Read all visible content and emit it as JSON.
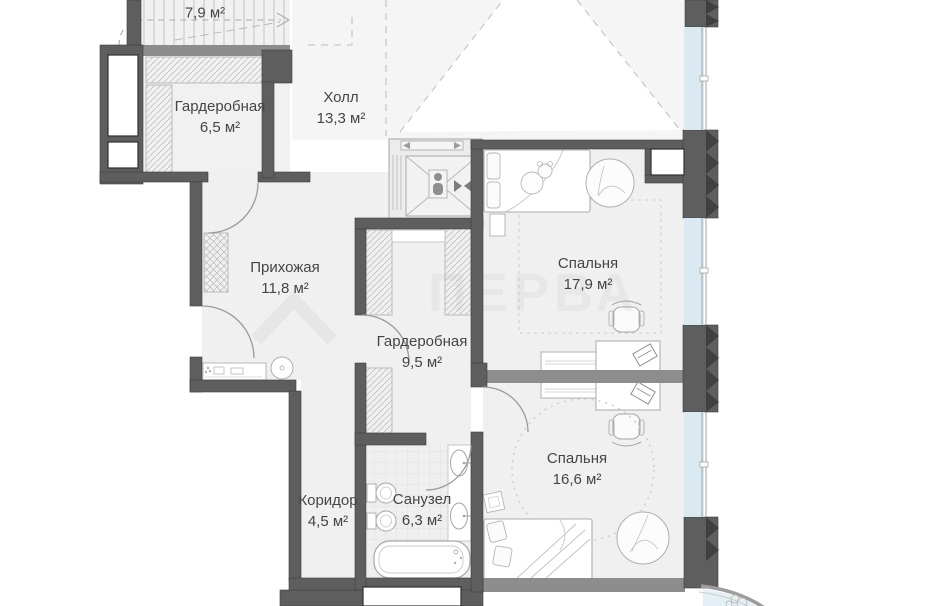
{
  "plan": {
    "type": "floor-plan",
    "language": "ru",
    "rooms": [
      {
        "id": "stairs",
        "name": "",
        "area": "7,9 м²"
      },
      {
        "id": "wardrobe-1",
        "name": "Гардеробная",
        "area": "6,5 м²"
      },
      {
        "id": "hall",
        "name": "Холл",
        "area": "13,3 м²"
      },
      {
        "id": "entry",
        "name": "Прихожая",
        "area": "11,8 м²"
      },
      {
        "id": "wardrobe-2",
        "name": "Гардеробная",
        "area": "9,5 м²"
      },
      {
        "id": "bedroom-1",
        "name": "Спальня",
        "area": "17,9 м²"
      },
      {
        "id": "bedroom-2",
        "name": "Спальня",
        "area": "16,6 м²"
      },
      {
        "id": "corridor",
        "name": "Коридор",
        "area": "4,5 м²"
      },
      {
        "id": "bathroom",
        "name": "Санузел",
        "area": "6,3 м²"
      }
    ],
    "colors": {
      "wall_dark": "#5e5e5e",
      "wall_medium": "#8d8d8d",
      "floor": "#f0f0f0",
      "glazing": "#d9eaf2",
      "furniture_line": "#b0b0b0",
      "label_text": "#454545"
    },
    "watermark": "ПЕРВА"
  }
}
